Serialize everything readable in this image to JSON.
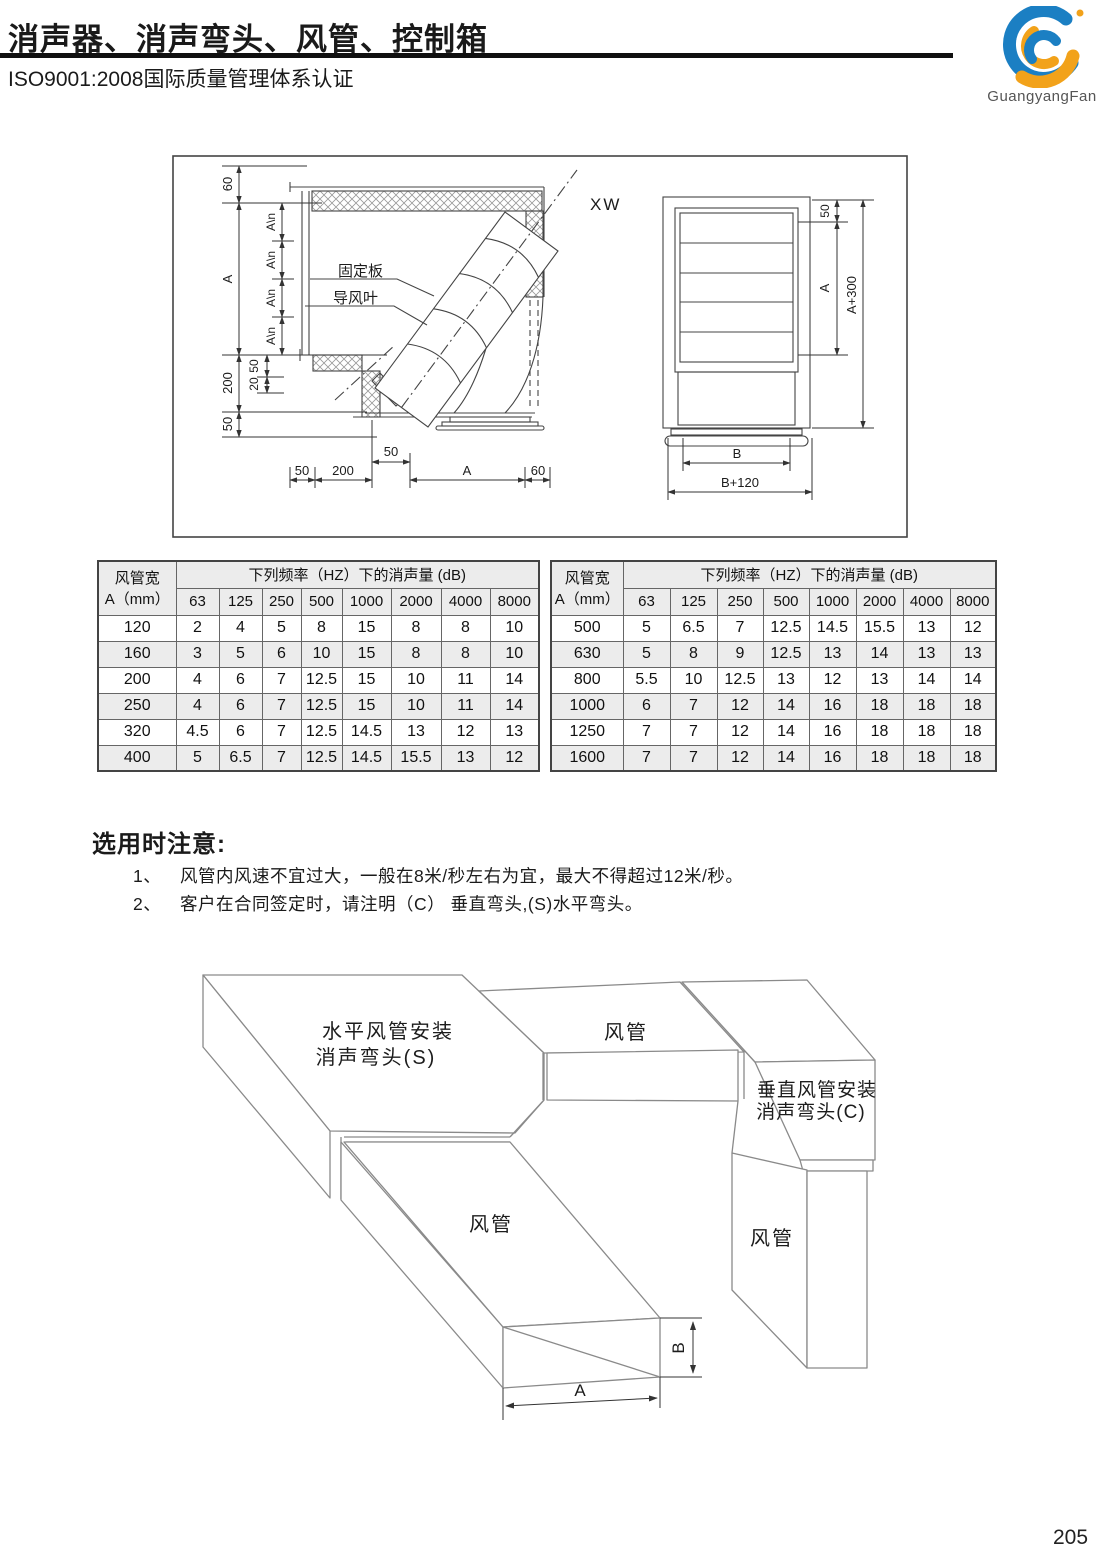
{
  "page": {
    "number": "205"
  },
  "header": {
    "title": "消声器、消声弯头、风管、控制箱",
    "subtitle": "ISO9001:2008国际质量管理体系认证",
    "logo_text": "GuangyangFan",
    "logo_blue": "#1b7fc3",
    "logo_orange": "#f2a21a"
  },
  "drawing": {
    "xw": "XW",
    "fixed_plate": "固定板",
    "guide_vane": "导风叶",
    "dims": {
      "top60": "60",
      "leftA": "A",
      "an": "A\\n",
      "inner50": "50",
      "inner20": "20",
      "left200": "200",
      "left50": "50",
      "bottom50": "50",
      "bottom200": "200",
      "bottom50s": "50",
      "bottomA": "A",
      "bottom60": "60",
      "front50": "50",
      "frontA": "A",
      "frontA300": "A+300",
      "frontB": "B",
      "frontB120": "B+120"
    }
  },
  "tables": [
    {
      "col_header_title": "风管宽",
      "col_header_sub": "A（mm）",
      "span_header": "下列频率（HZ）下的消声量 (dB)",
      "freqs": [
        "63",
        "125",
        "250",
        "500",
        "1000",
        "2000",
        "4000",
        "8000"
      ],
      "rows": [
        [
          "120",
          "2",
          "4",
          "5",
          "8",
          "15",
          "8",
          "8",
          "10"
        ],
        [
          "160",
          "3",
          "5",
          "6",
          "10",
          "15",
          "8",
          "8",
          "10"
        ],
        [
          "200",
          "4",
          "6",
          "7",
          "12.5",
          "15",
          "10",
          "11",
          "14"
        ],
        [
          "250",
          "4",
          "6",
          "7",
          "12.5",
          "15",
          "10",
          "11",
          "14"
        ],
        [
          "320",
          "4.5",
          "6",
          "7",
          "12.5",
          "14.5",
          "13",
          "12",
          "13"
        ],
        [
          "400",
          "5",
          "6.5",
          "7",
          "12.5",
          "14.5",
          "15.5",
          "13",
          "12"
        ]
      ]
    },
    {
      "col_header_title": "风管宽",
      "col_header_sub": "A（mm）",
      "span_header": "下列频率（HZ）下的消声量 (dB)",
      "freqs": [
        "63",
        "125",
        "250",
        "500",
        "1000",
        "2000",
        "4000",
        "8000"
      ],
      "rows": [
        [
          "500",
          "5",
          "6.5",
          "7",
          "12.5",
          "14.5",
          "15.5",
          "13",
          "12"
        ],
        [
          "630",
          "5",
          "8",
          "9",
          "12.5",
          "13",
          "14",
          "13",
          "13"
        ],
        [
          "800",
          "5.5",
          "10",
          "12.5",
          "13",
          "12",
          "13",
          "14",
          "14"
        ],
        [
          "1000",
          "6",
          "7",
          "12",
          "14",
          "16",
          "18",
          "18",
          "18"
        ],
        [
          "1250",
          "7",
          "7",
          "12",
          "14",
          "16",
          "18",
          "18",
          "18"
        ],
        [
          "1600",
          "7",
          "7",
          "12",
          "14",
          "16",
          "18",
          "18",
          "18"
        ]
      ]
    }
  ],
  "notes": {
    "heading": "选用时注意:",
    "items": [
      {
        "num": "1、",
        "text": "风管内风速不宜过大，一般在8米/秒左右为宜，最大不得超过12米/秒。"
      },
      {
        "num": "2、",
        "text": "客户在合同签定时，请注明（C） 垂直弯头,(S)水平弯头。"
      }
    ]
  },
  "iso": {
    "s_label_1": "水平风管安装",
    "s_label_2": "消声弯头(S)",
    "duct_top": "风管",
    "c_label_1": "垂直风管安装",
    "c_label_2": "消声弯头(C)",
    "duct_bottom": "风管",
    "duct_right": "风管",
    "dim_a": "A",
    "dim_b": "B"
  }
}
